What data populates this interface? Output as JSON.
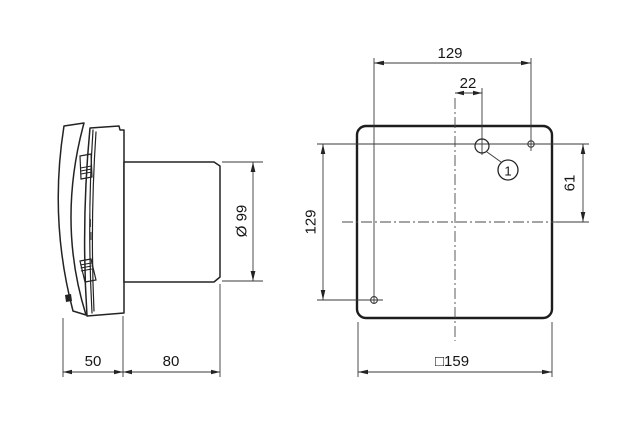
{
  "drawing": {
    "background": "#ffffff",
    "line_color": "#232323",
    "side_view": {
      "duct_diameter": "Ø 99",
      "cover_depth": "50",
      "duct_length": "80"
    },
    "front_view": {
      "hole_spacing_horizontal": "129",
      "hole_offset_from_center": "22",
      "hole_height_above_center": "61",
      "hole_spacing_vertical": "129",
      "outer_size": "□159",
      "callout": "1"
    }
  }
}
